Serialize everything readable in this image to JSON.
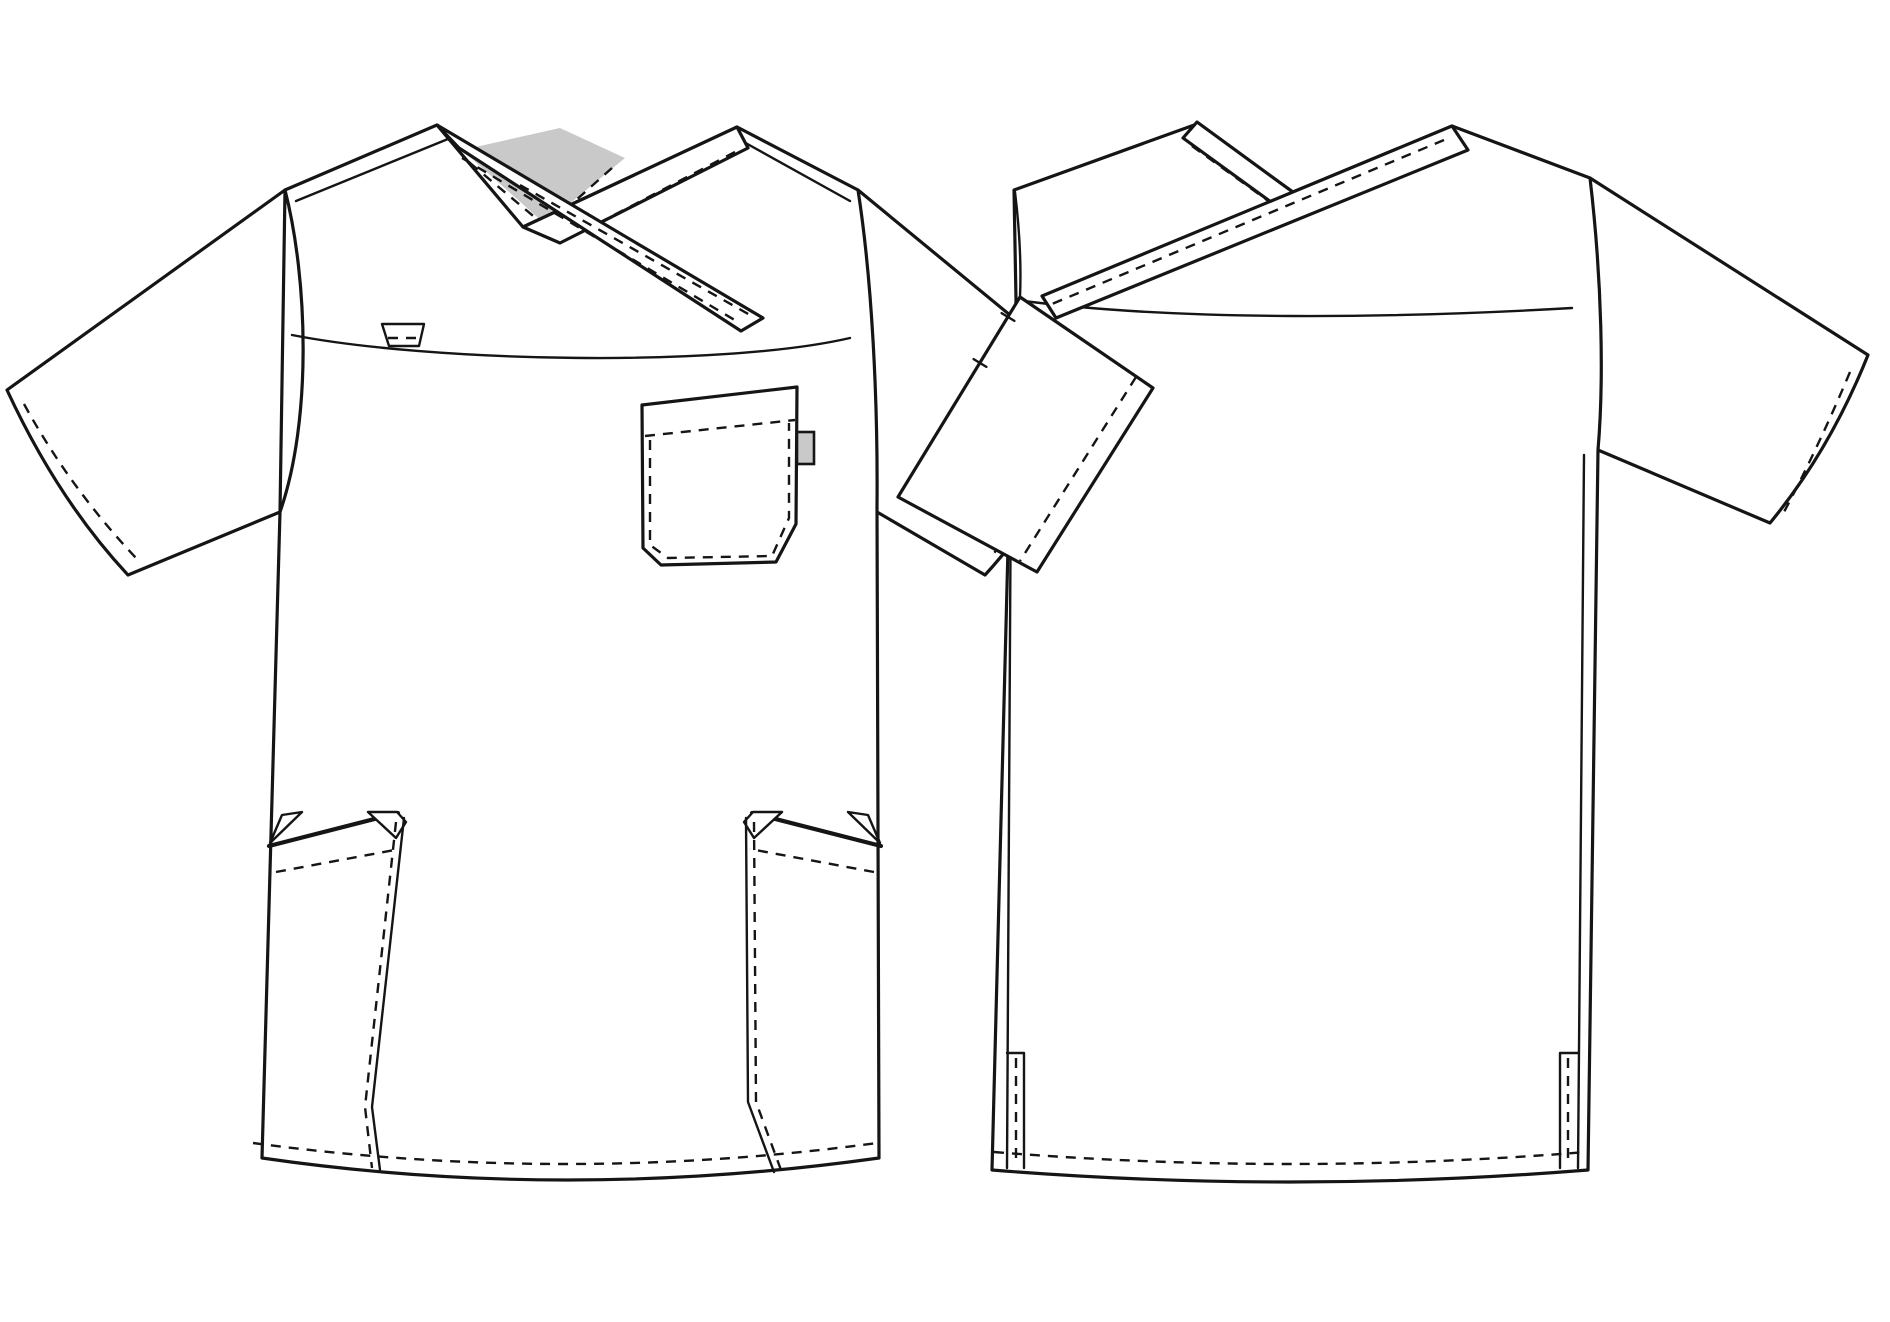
{
  "figure": {
    "aria_label": "Technical flat sketch of a mock-wrap V-neck scrub top, front and back views, black line art on white",
    "views": {
      "front": {
        "label": "scrub-top-front-view"
      },
      "back": {
        "label": "scrub-top-back-view"
      }
    },
    "features": {
      "front": [
        "crossover-v-neck-band",
        "shaded-inner-neck",
        "chest-pocket-with-side-tab",
        "yoke-seam-tab",
        "two-lower-side-pockets",
        "short-sleeves-with-stitched-hems",
        "curved-bottom-hem-with-stitching"
      ],
      "back": [
        "crossed-neck-bands",
        "back-yoke-seam",
        "side-panel-seams",
        "side-hem-vents",
        "short-sleeves-with-stitched-hems",
        "curved-bottom-hem-with-stitching"
      ]
    }
  },
  "colors": {
    "background": "#ffffff",
    "line": "#151515",
    "fill": "#ffffff",
    "shade": "#c9c9c9"
  }
}
